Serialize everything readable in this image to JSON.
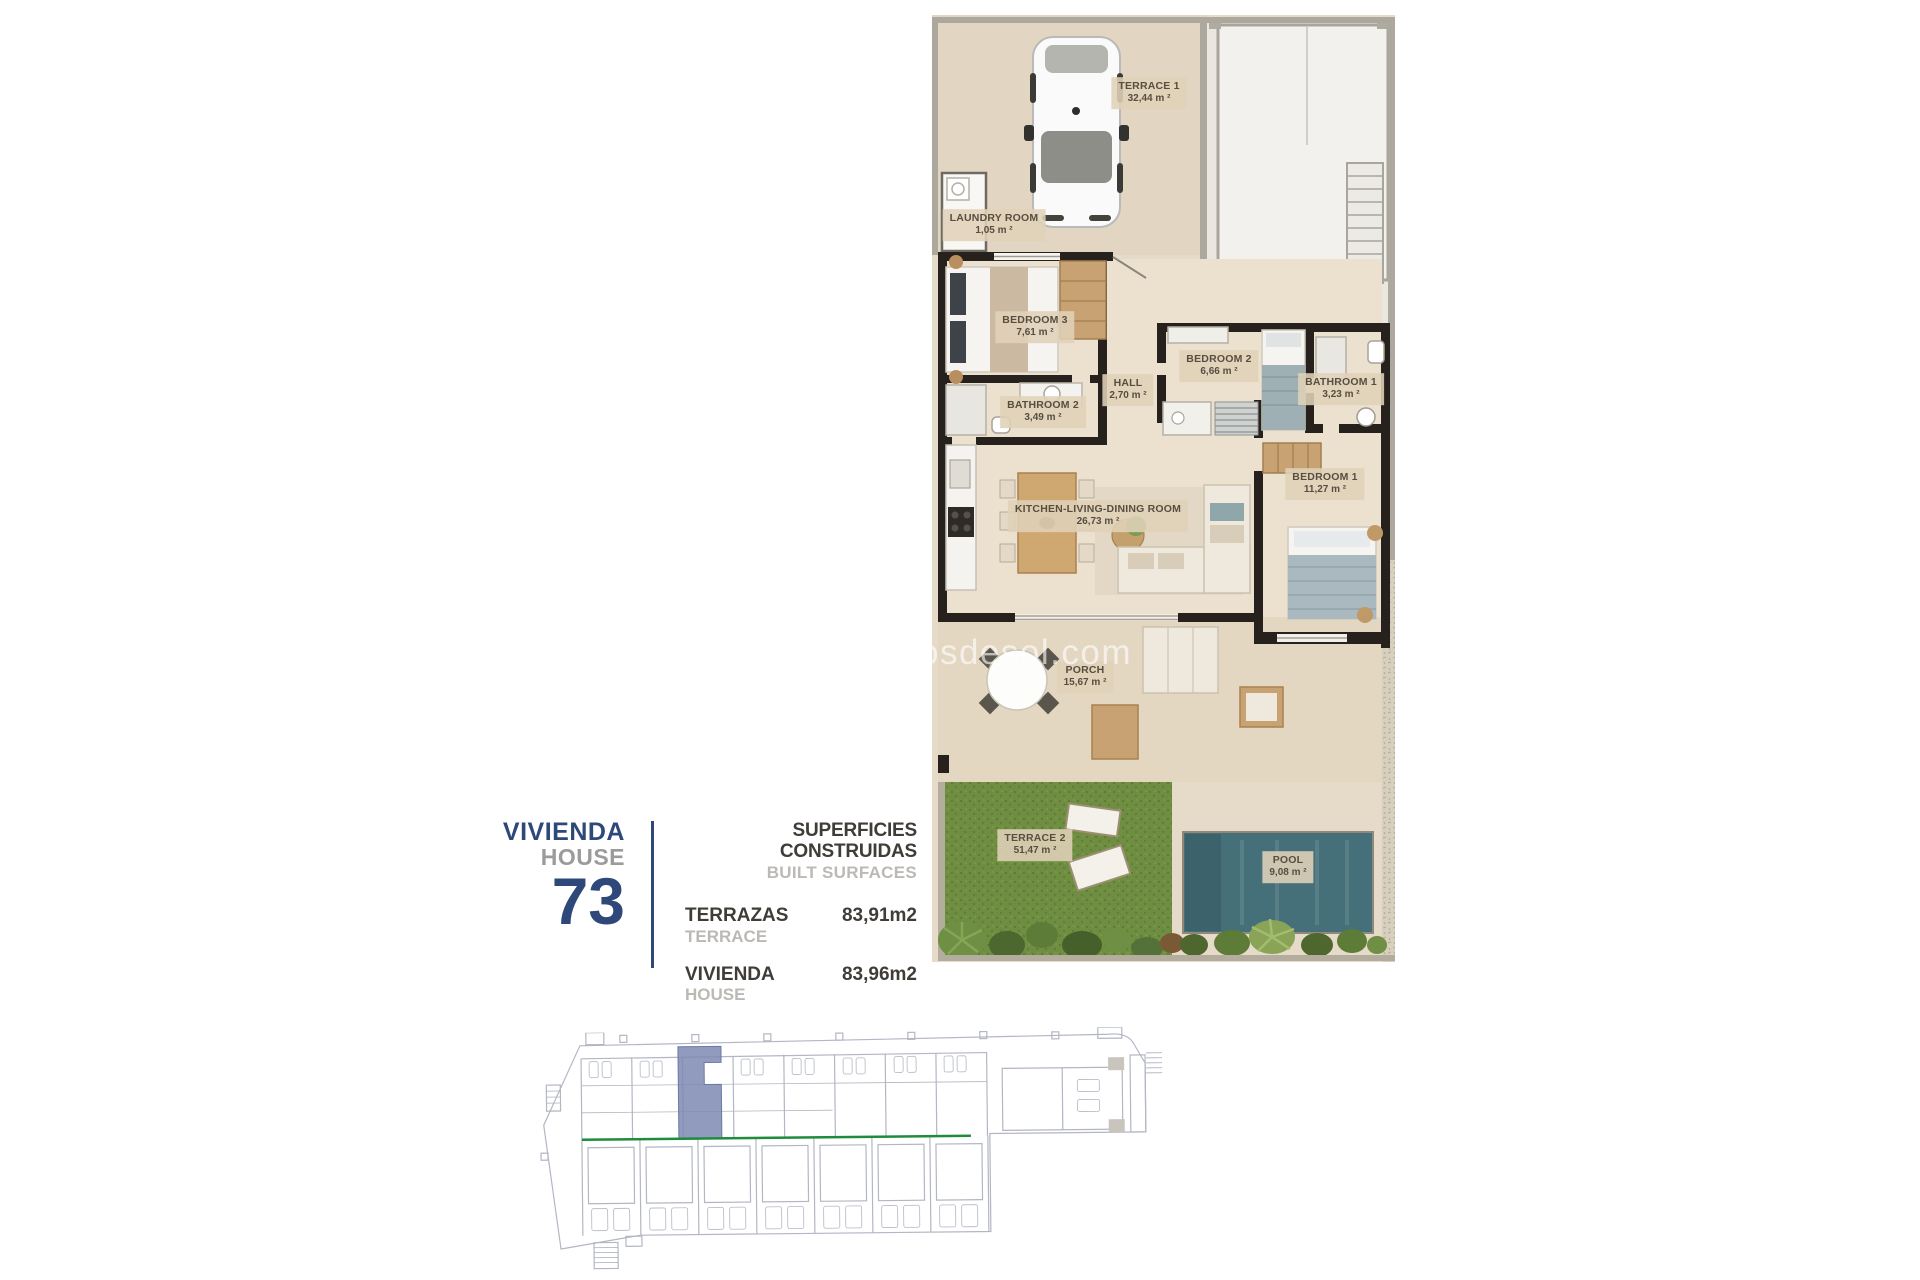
{
  "page": {
    "background": "#ffffff"
  },
  "watermark": {
    "text": "osdesol.com"
  },
  "info_panel": {
    "title_line1": "VIVIENDA",
    "title_line2": "HOUSE",
    "unit_number": "73",
    "accent_color": "#2e4879",
    "table": {
      "header_primary": "SUPERFICIES CONSTRUIDAS",
      "header_secondary": "BUILT SURFACES",
      "rows": [
        {
          "label_primary": "TERRAZAS",
          "label_secondary": "TERRACE",
          "value": "83,91m2"
        },
        {
          "label_primary": "VIVIENDA",
          "label_secondary": "HOUSE",
          "value": "83,96m2"
        }
      ]
    }
  },
  "floorplan": {
    "rooms": [
      {
        "name": "TERRACE 1",
        "area": "32,44 m ²"
      },
      {
        "name": "LAUNDRY ROOM",
        "area": "1,05 m ²"
      },
      {
        "name": "BEDROOM 3",
        "area": "7,61 m ²"
      },
      {
        "name": "BEDROOM 2",
        "area": "6,66 m ²"
      },
      {
        "name": "BATHROOM 1",
        "area": "3,23 m ²"
      },
      {
        "name": "HALL",
        "area": "2,70 m ²"
      },
      {
        "name": "BATHROOM 2",
        "area": "3,49 m ²"
      },
      {
        "name": "BEDROOM 1",
        "area": "11,27 m ²"
      },
      {
        "name": "KITCHEN-LIVING-DINING ROOM",
        "area": "26,73 m ²"
      },
      {
        "name": "PORCH",
        "area": "15,67 m ²"
      },
      {
        "name": "TERRACE 2",
        "area": "51,47 m ²"
      },
      {
        "name": "POOL",
        "area": "9,08 m ²"
      }
    ],
    "colors": {
      "floor_beige": "#e6dbc9",
      "wall_black": "#26211c",
      "grass_green": "#6f8e41",
      "pool_teal": "#467079",
      "label_background": "#e0d1b8"
    }
  },
  "site_plan": {
    "line_color": "#b3b6c3",
    "green_line_color": "#1f8b3c",
    "highlight_color": "#8d99be"
  }
}
